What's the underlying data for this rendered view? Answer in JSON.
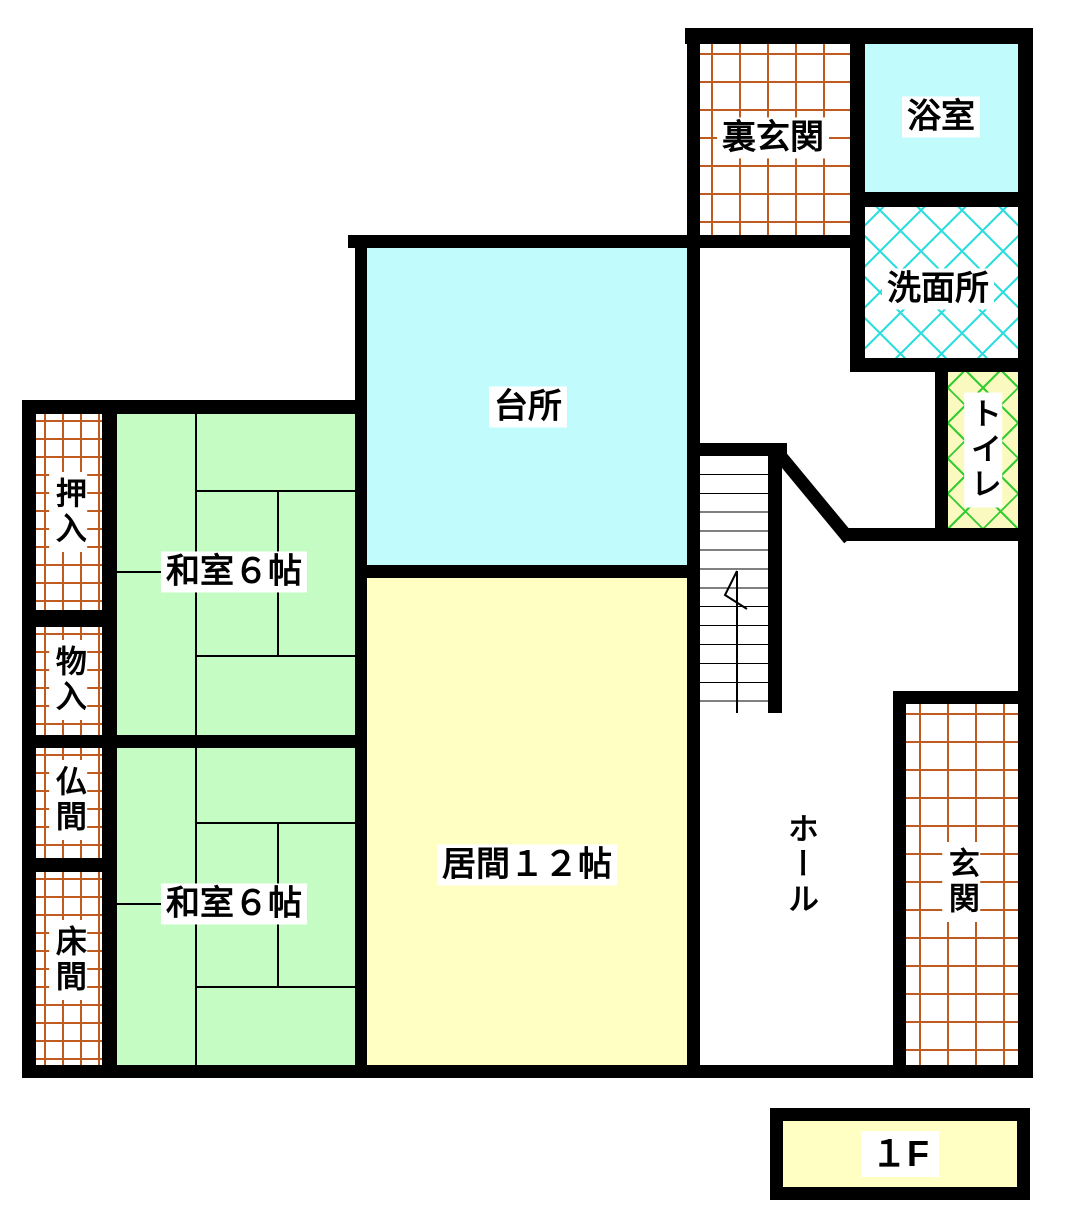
{
  "floor_plan": {
    "floor_badge": {
      "label": "１F"
    },
    "rooms": {
      "ura_genkan": {
        "label": "裏玄関",
        "type": "back-entrance",
        "pattern": "orange-grid"
      },
      "yokushitsu": {
        "label": "浴室",
        "type": "bathroom",
        "fill": "#c2fbfc"
      },
      "senmenjo": {
        "label": "洗面所",
        "type": "washroom",
        "pattern": "cyan-crosshatch"
      },
      "toire": {
        "label": "トイレ",
        "type": "toilet",
        "pattern": "green-crosshatch"
      },
      "daidokoro": {
        "label": "台所",
        "type": "kitchen",
        "fill": "#c2fbfc"
      },
      "washitsu_1": {
        "label": "和室６帖",
        "type": "japanese-room-6-tatami",
        "fill": "#c4fcc4"
      },
      "washitsu_2": {
        "label": "和室６帖",
        "type": "japanese-room-6-tatami",
        "fill": "#c4fcc4"
      },
      "ima": {
        "label": "居間１２帖",
        "type": "living-room-12-tatami",
        "fill": "#ffffc4"
      },
      "hooru": {
        "label": "ホール",
        "type": "hall",
        "fill": "#ffffff"
      },
      "genkan": {
        "label": "玄関",
        "type": "entrance",
        "pattern": "orange-grid"
      },
      "oshiire": {
        "label": "押入",
        "type": "closet",
        "pattern": "orange-grid"
      },
      "monoire": {
        "label": "物入",
        "type": "storage",
        "pattern": "orange-grid"
      },
      "butsuma": {
        "label": "仏間",
        "type": "altar-room",
        "pattern": "orange-grid"
      },
      "tokonoma": {
        "label": "床間",
        "type": "alcove",
        "pattern": "orange-grid"
      }
    },
    "colors": {
      "wall": "#000000",
      "water_room_cyan": "#c2fbfc",
      "tatami_green": "#c4fcc4",
      "living_yellow": "#ffffc4",
      "toilet_pale_yellow": "#fafac0",
      "grid_line_orange": "#bf5b1f",
      "washroom_hatch_cyan": "#2edede",
      "toilet_hatch_green": "#33cc33"
    }
  }
}
